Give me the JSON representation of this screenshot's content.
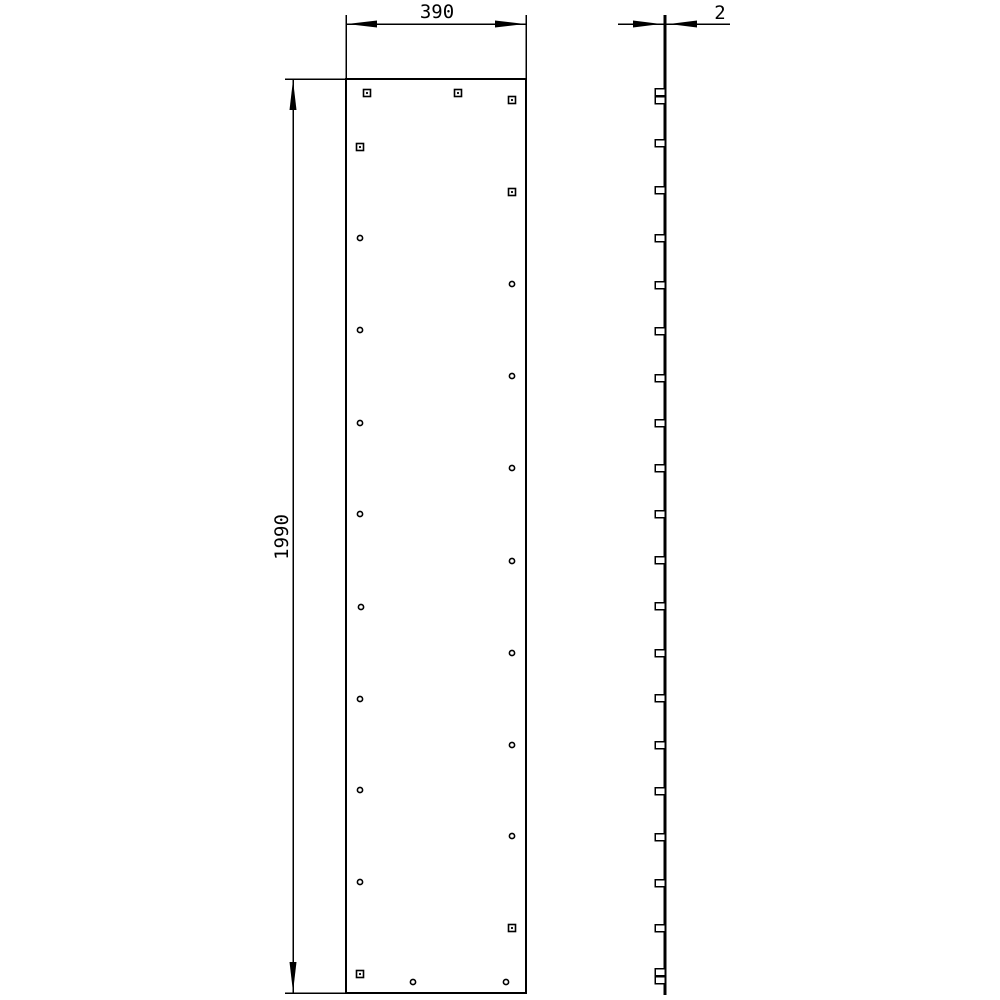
{
  "drawing": {
    "type": "technical-drawing-two-views",
    "description": "Flat rectangular panel, front view with staggered mounting holes and side profile view with clip tabs",
    "colors": {
      "line": "#000000",
      "background": "#ffffff"
    }
  },
  "dimensions": {
    "width": {
      "label": "390"
    },
    "height": {
      "label": "1990"
    },
    "thickness": {
      "label": "2"
    }
  },
  "front_view": {
    "panel": {
      "x": 346,
      "y": 79,
      "width": 180,
      "height": 914
    },
    "hole_square_size": 7,
    "hole_circle_radius": 2.6,
    "holes": [
      {
        "x": 367,
        "y": 93,
        "shape": "square"
      },
      {
        "x": 458,
        "y": 93,
        "shape": "square"
      },
      {
        "x": 512,
        "y": 100,
        "shape": "square"
      },
      {
        "x": 360,
        "y": 147,
        "shape": "square"
      },
      {
        "x": 512,
        "y": 192,
        "shape": "square"
      },
      {
        "x": 360,
        "y": 238,
        "shape": "circle"
      },
      {
        "x": 512,
        "y": 284,
        "shape": "circle"
      },
      {
        "x": 360,
        "y": 330,
        "shape": "circle"
      },
      {
        "x": 512,
        "y": 376,
        "shape": "circle"
      },
      {
        "x": 360,
        "y": 423,
        "shape": "circle"
      },
      {
        "x": 512,
        "y": 468,
        "shape": "circle"
      },
      {
        "x": 360,
        "y": 514,
        "shape": "circle"
      },
      {
        "x": 512,
        "y": 561,
        "shape": "circle"
      },
      {
        "x": 361,
        "y": 607,
        "shape": "circle"
      },
      {
        "x": 512,
        "y": 653,
        "shape": "circle"
      },
      {
        "x": 360,
        "y": 699,
        "shape": "circle"
      },
      {
        "x": 512,
        "y": 745,
        "shape": "circle"
      },
      {
        "x": 360,
        "y": 790,
        "shape": "circle"
      },
      {
        "x": 512,
        "y": 836,
        "shape": "circle"
      },
      {
        "x": 360,
        "y": 882,
        "shape": "circle"
      },
      {
        "x": 512,
        "y": 928,
        "shape": "square"
      },
      {
        "x": 360,
        "y": 974,
        "shape": "square"
      },
      {
        "x": 413,
        "y": 982,
        "shape": "circle"
      },
      {
        "x": 506,
        "y": 982,
        "shape": "circle"
      }
    ]
  },
  "side_view": {
    "line": {
      "x": 665,
      "y1": 15,
      "y2": 995
    },
    "tab": {
      "width": 10,
      "height": 7
    },
    "tab_positions": [
      92,
      100,
      143,
      190,
      238,
      285,
      331,
      378,
      423,
      468,
      514,
      560,
      606,
      653,
      698,
      745,
      791,
      837,
      883,
      928,
      972,
      980
    ]
  }
}
